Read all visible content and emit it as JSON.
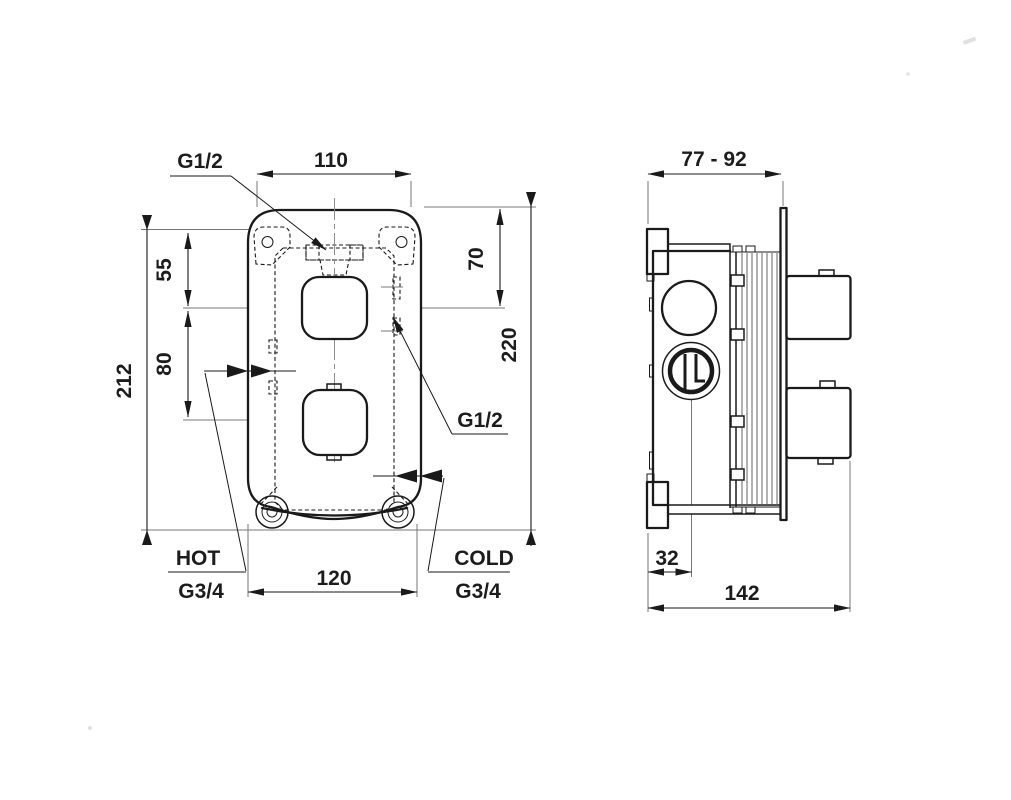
{
  "drawing": {
    "front_view": {
      "dimensions": {
        "top_width": "110",
        "screw_to_center": "55",
        "top_to_handle": "70",
        "handle_spacing": "80",
        "mount_height": "212",
        "overall_height": "220",
        "bottom_width": "120"
      },
      "ports": {
        "top_outlet": "G1/2",
        "side_outlet": "G1/2",
        "hot_label": "HOT",
        "hot_thread": "G3/4",
        "cold_label": "COLD",
        "cold_thread": "G3/4"
      }
    },
    "side_view": {
      "dimensions": {
        "install_depth": "77 - 92",
        "cartridge_offset": "32",
        "overall_depth": "142"
      }
    },
    "colors": {
      "line": "#1a1a1a",
      "centerline": "#8f8f8f",
      "background": "#ffffff"
    }
  }
}
